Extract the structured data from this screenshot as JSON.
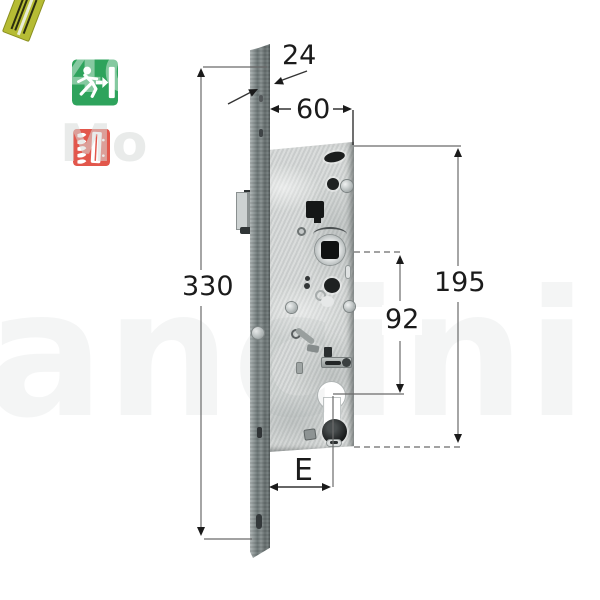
{
  "icons": {
    "emergency_exit": {
      "name": "emergency-exit",
      "bg": "#2ea35c"
    },
    "fire_door": {
      "name": "fire-door",
      "bg": "#e2574c"
    }
  },
  "watermark": {
    "fragment_top": "4G",
    "fragment_mid": "Mo",
    "fragment_center": "ancini"
  },
  "dimensions": {
    "faceplate_width": "24",
    "case_depth": "60",
    "faceplate_height": "330",
    "case_height": "195",
    "handle_to_cylinder": "92",
    "backset": "E"
  },
  "colors": {
    "sticker": "#b6bc34",
    "dimension_line": "#555555",
    "dimension_text": "#1b1b1b",
    "exit_icon_green": "#2ea35c",
    "fire_icon_red": "#e2574c"
  }
}
